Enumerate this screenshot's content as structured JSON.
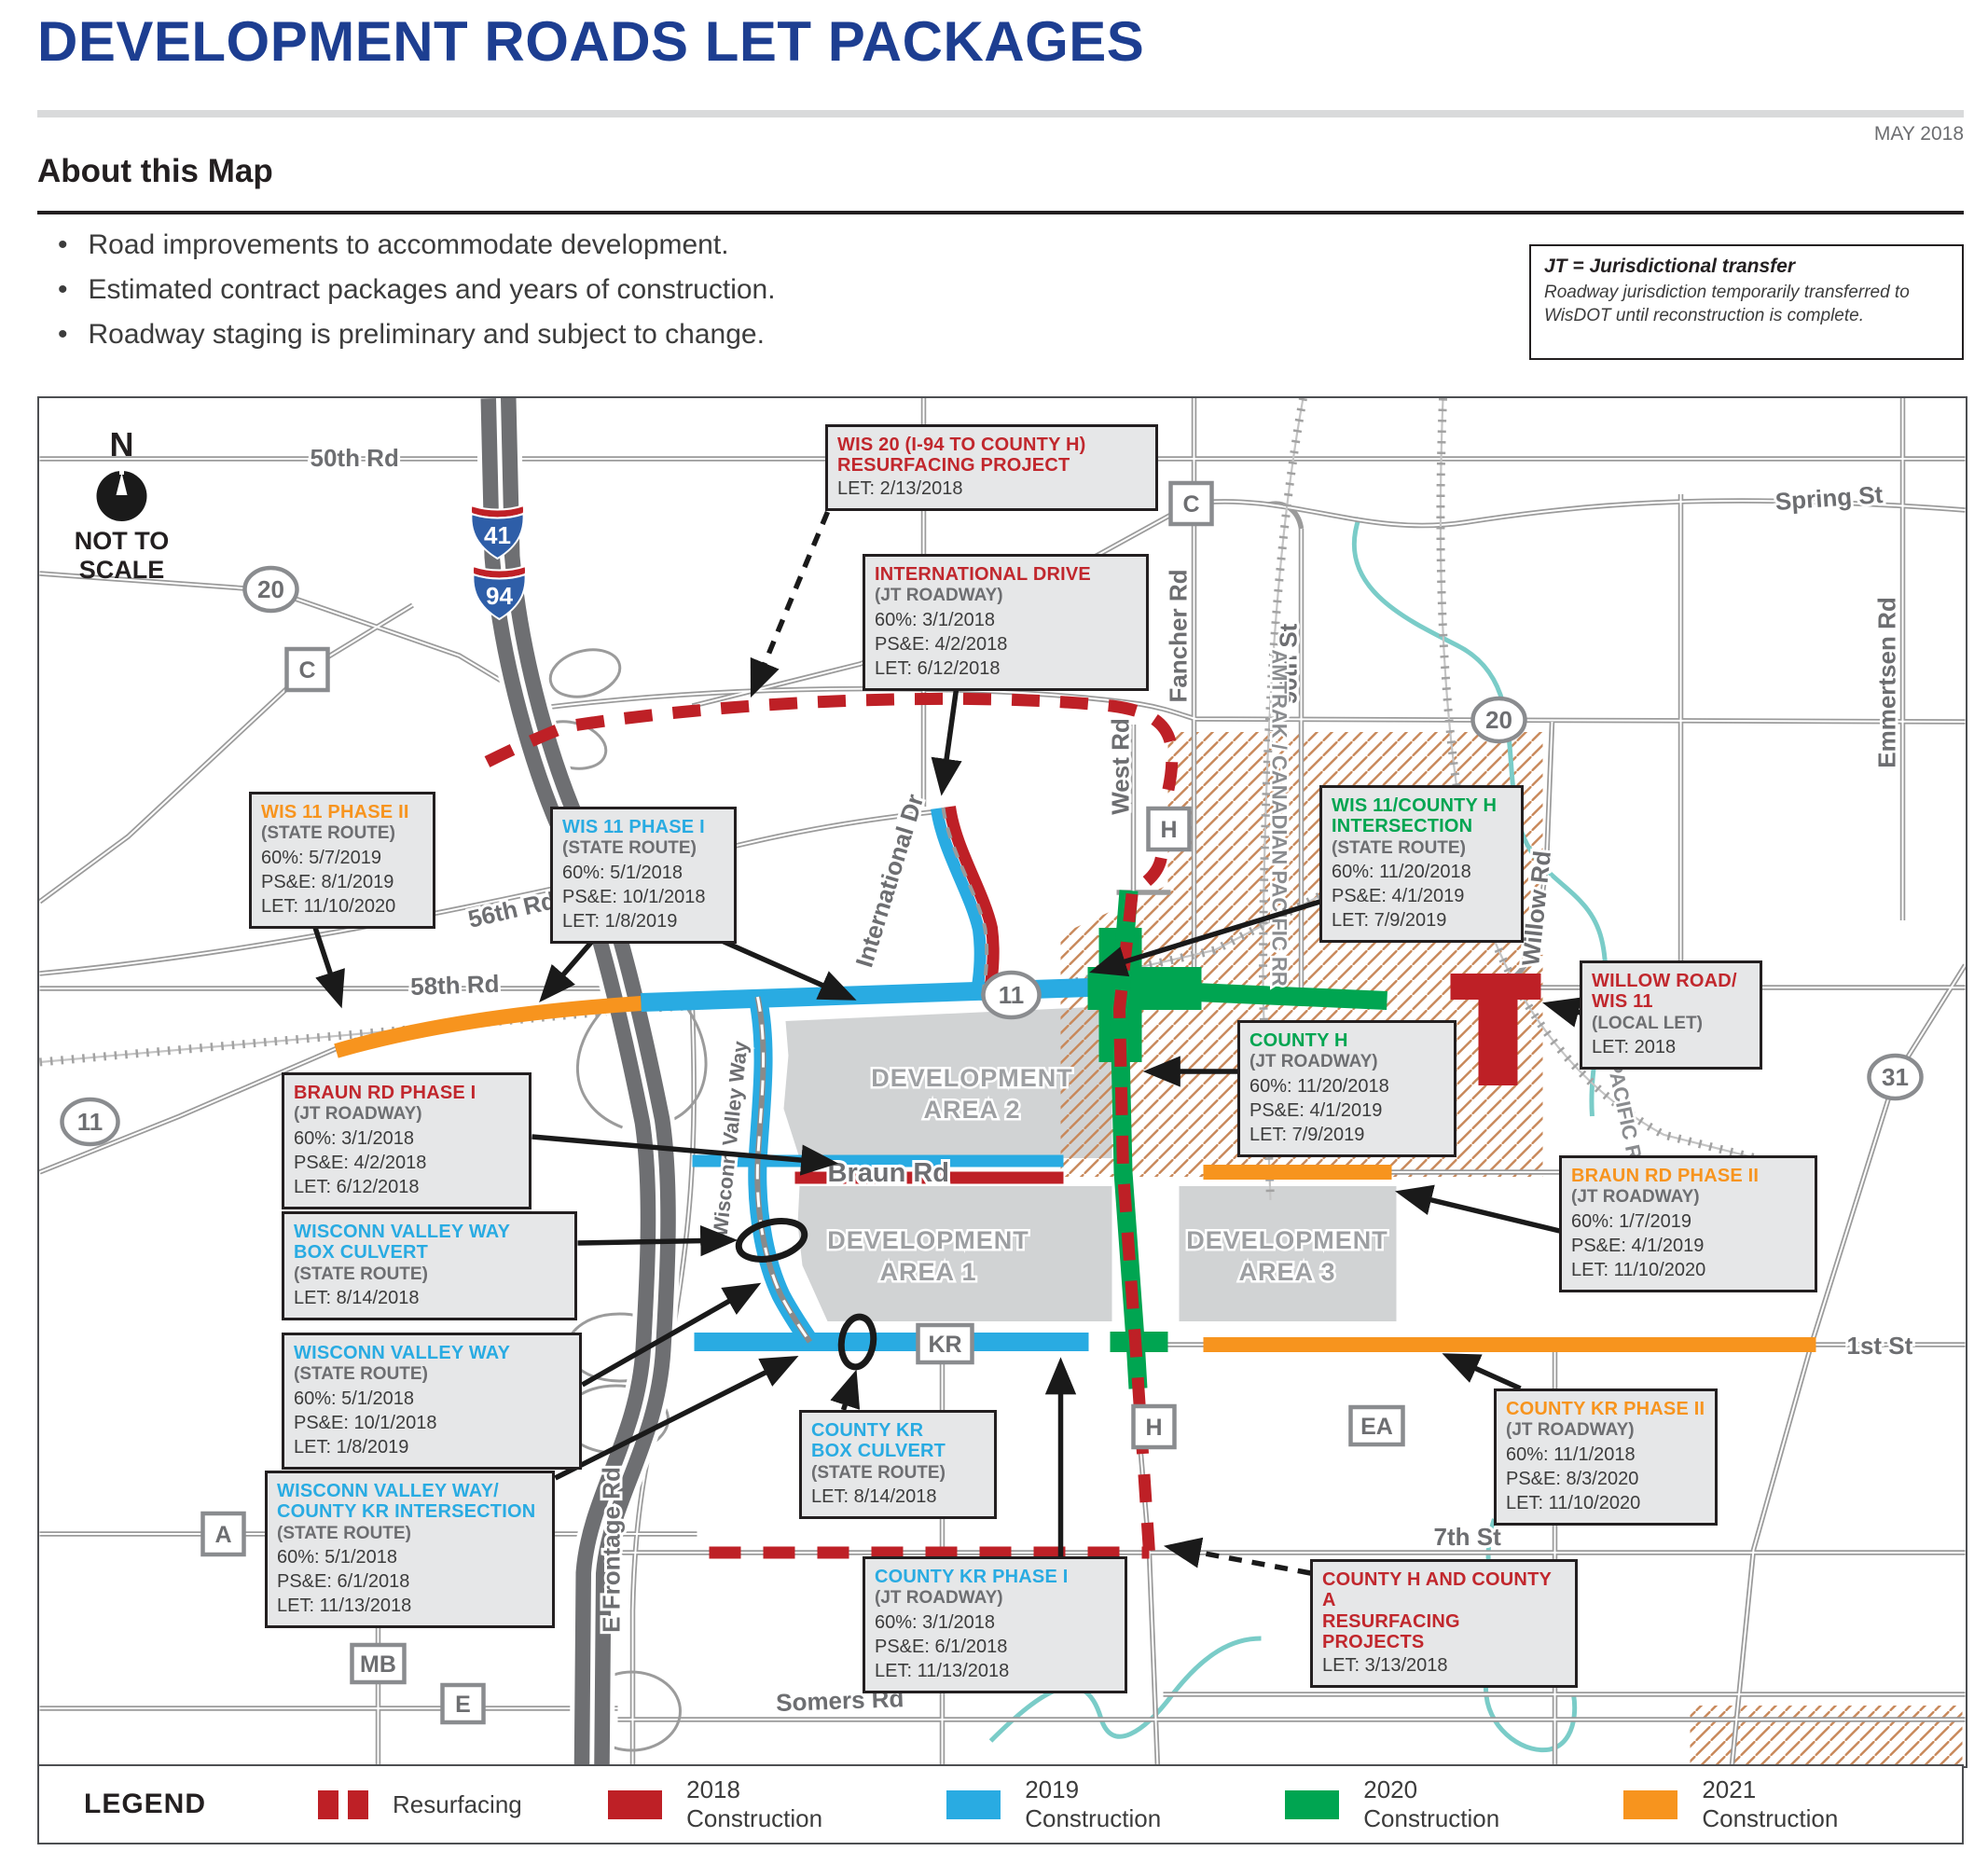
{
  "header": {
    "title": "DEVELOPMENT ROADS LET PACKAGES",
    "date": "MAY 2018",
    "about_heading": "About this Map",
    "bullets": [
      "Road improvements to accommodate development.",
      "Estimated contract packages and years of construction.",
      "Roadway staging is preliminary and subject to change."
    ]
  },
  "jt_note": {
    "title": "JT = Jurisdictional transfer",
    "body": "Roadway jurisdiction temporarily transferred to WisDOT until reconstruction is complete."
  },
  "compass": {
    "north": "N",
    "note_line1": "NOT TO",
    "note_line2": "SCALE"
  },
  "colors": {
    "title_blue": "#1d3e91",
    "resurfacing": "#be2026",
    "construction_2018": "#be2026",
    "construction_2019": "#29abe2",
    "construction_2020": "#00a551",
    "construction_2021": "#f7941e"
  },
  "map": {
    "streets": {
      "rd50": "50th Rd",
      "spring": "Spring St",
      "rd56": "56th Rd",
      "rd58": "58th Rd",
      "braun": "Braun Rd",
      "first": "1st St",
      "seventh": "7th St",
      "somers": "Somers Rd",
      "west": "West Rd",
      "fancher": "Fancher Rd",
      "st90": "90th St",
      "emmertsen": "Emmertsen Rd",
      "willow": "Willow Rd",
      "international": "International Dr",
      "wisconn": "Wisconn Valley Way",
      "frontage": "E Frontage Rd",
      "amtrak": "AMTRAK / CANADIAN PACIFIC RR",
      "union": "UNION PACIFIC RR"
    },
    "areas": [
      {
        "l1": "DEVELOPMENT",
        "l2": "AREA 2"
      },
      {
        "l1": "DEVELOPMENT",
        "l2": "AREA 1"
      },
      {
        "l1": "DEVELOPMENT",
        "l2": "AREA 3"
      }
    ],
    "shields": [
      {
        "route": "41"
      },
      {
        "route": "94"
      }
    ],
    "route_ovals": [
      {
        "label": "20"
      },
      {
        "label": "20"
      },
      {
        "label": "11"
      },
      {
        "label": "11"
      },
      {
        "label": "31"
      }
    ],
    "county_markers": [
      {
        "label": "C"
      },
      {
        "label": "C"
      },
      {
        "label": "H"
      },
      {
        "label": "H"
      },
      {
        "label": "A"
      },
      {
        "label": "MB"
      },
      {
        "label": "E"
      },
      {
        "label": "EA"
      },
      {
        "label": "KR"
      }
    ],
    "callouts": [
      {
        "title": "WIS 20 (I-94 TO COUNTY H)\nRESURFACING PROJECT",
        "rows": [
          "LET: 2/13/2018"
        ]
      },
      {
        "title": "INTERNATIONAL DRIVE",
        "sub": "(JT ROADWAY)",
        "rows": [
          "60%: 3/1/2018",
          "PS&E: 4/2/2018",
          "LET: 6/12/2018"
        ]
      },
      {
        "title": "WIS 11 PHASE II",
        "sub": "(STATE ROUTE)",
        "rows": [
          "60%: 5/7/2019",
          "PS&E: 8/1/2019",
          "LET: 11/10/2020"
        ]
      },
      {
        "title": "WIS 11 PHASE I",
        "sub": "(STATE ROUTE)",
        "rows": [
          "60%: 5/1/2018",
          "PS&E: 10/1/2018",
          "LET: 1/8/2019"
        ]
      },
      {
        "title": "WIS 11/COUNTY H\nINTERSECTION",
        "sub": "(STATE ROUTE)",
        "rows": [
          "60%: 11/20/2018",
          "PS&E: 4/1/2019",
          "LET: 7/9/2019"
        ]
      },
      {
        "title": "WILLOW ROAD/\nWIS 11",
        "sub": "(LOCAL LET)",
        "rows": [
          "LET: 2018"
        ]
      },
      {
        "title": "COUNTY H",
        "sub": "(JT ROADWAY)",
        "rows": [
          "60%: 11/20/2018",
          "PS&E: 4/1/2019",
          "LET: 7/9/2019"
        ]
      },
      {
        "title": "BRAUN RD PHASE I",
        "sub": "(JT ROADWAY)",
        "rows": [
          "60%: 3/1/2018",
          "PS&E: 4/2/2018",
          "LET: 6/12/2018"
        ]
      },
      {
        "title": "BRAUN RD PHASE II",
        "sub": "(JT ROADWAY)",
        "rows": [
          "60%: 1/7/2019",
          "PS&E: 4/1/2019",
          "LET: 11/10/2020"
        ]
      },
      {
        "title": "WISCONN VALLEY WAY\nBOX CULVERT",
        "sub": "(STATE ROUTE)",
        "rows": [
          "LET: 8/14/2018"
        ]
      },
      {
        "title": "WISCONN VALLEY WAY",
        "sub": "(STATE ROUTE)",
        "rows": [
          "60%: 5/1/2018",
          "PS&E: 10/1/2018",
          "LET: 1/8/2019"
        ]
      },
      {
        "title": "WISCONN VALLEY WAY/\nCOUNTY KR INTERSECTION",
        "sub": "(STATE ROUTE)",
        "rows": [
          "60%: 5/1/2018",
          "PS&E: 6/1/2018",
          "LET: 11/13/2018"
        ]
      },
      {
        "title": "COUNTY KR\nBOX CULVERT",
        "sub": "(STATE ROUTE)",
        "rows": [
          "LET: 8/14/2018"
        ]
      },
      {
        "title": "COUNTY KR PHASE II",
        "sub": "(JT ROADWAY)",
        "rows": [
          "60%: 11/1/2018",
          "PS&E: 8/3/2020",
          "LET: 11/10/2020"
        ]
      },
      {
        "title": "COUNTY KR PHASE I",
        "sub": "(JT ROADWAY)",
        "rows": [
          "60%: 3/1/2018",
          "PS&E: 6/1/2018",
          "LET: 11/13/2018"
        ]
      },
      {
        "title": "COUNTY H AND COUNTY A\nRESURFACING PROJECTS",
        "rows": [
          "LET: 3/13/2018"
        ]
      }
    ]
  },
  "legend": {
    "heading": "LEGEND",
    "items": [
      {
        "label": "Resurfacing"
      },
      {
        "label": "2018 Construction"
      },
      {
        "label": "2019 Construction"
      },
      {
        "label": "2020 Construction"
      },
      {
        "label": "2021 Construction"
      }
    ]
  }
}
